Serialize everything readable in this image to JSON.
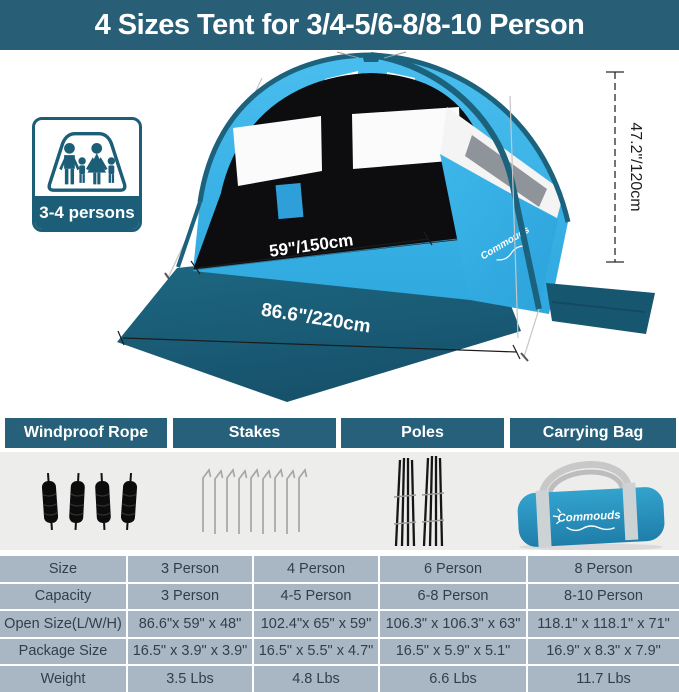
{
  "title": "4 Sizes Tent for 3/4-5/6-8/8-10 Person",
  "badge": {
    "capacity_label": "3-4 persons",
    "icon": "family-in-tent-icon"
  },
  "tent_diagram": {
    "width_label": "59\"/150cm",
    "length_label": "86.6\"/220cm",
    "height_label": "47.2\"/120cm",
    "brand_logo": "Commouds"
  },
  "accessories": {
    "sections": [
      {
        "label": "Windproof Rope",
        "icon": "rope-icon"
      },
      {
        "label": "Stakes",
        "icon": "stake-icon"
      },
      {
        "label": "Poles",
        "icon": "pole-icon"
      },
      {
        "label": "Carrying Bag",
        "icon": "bag-icon"
      }
    ],
    "bag_logo": "Commouds"
  },
  "spec_table": {
    "rows": [
      {
        "label": "Size",
        "values": [
          "3 Person",
          "4 Person",
          "6 Person",
          "8 Person"
        ]
      },
      {
        "label": "Capacity",
        "values": [
          "3 Person",
          "4-5 Person",
          "6-8 Person",
          "8-10 Person"
        ]
      },
      {
        "label": "Open Size(L/W/H)",
        "values": [
          "86.6\"x 59\" x 48\"",
          "102.4\"x 65\" x 59\"",
          "106.3\" x 106.3\" x 63\"",
          "118.1\" x 118.1\" x 71\""
        ]
      },
      {
        "label": "Package Size",
        "values": [
          "16.5\" x 3.9\" x 3.9\"",
          "16.5\" x 5.5\" x 4.7\"",
          "16.5\" x 5.9\" x 5.1\"",
          "16.9\" x 8.3\" x 7.9\""
        ]
      },
      {
        "label": "Weight",
        "values": [
          "3.5 Lbs",
          "4.8 Lbs",
          "6.6 Lbs",
          "11.7 Lbs"
        ]
      }
    ]
  },
  "colors": {
    "accent_teal": "#285E76",
    "header_teal": "#26607A",
    "badge_teal": "#1C5E78",
    "canopy_blue": "#38B3E8",
    "floor_teal": "#1A5C77",
    "table_cell": "#A9B7C5",
    "band_gray": "#EDEDEC"
  }
}
